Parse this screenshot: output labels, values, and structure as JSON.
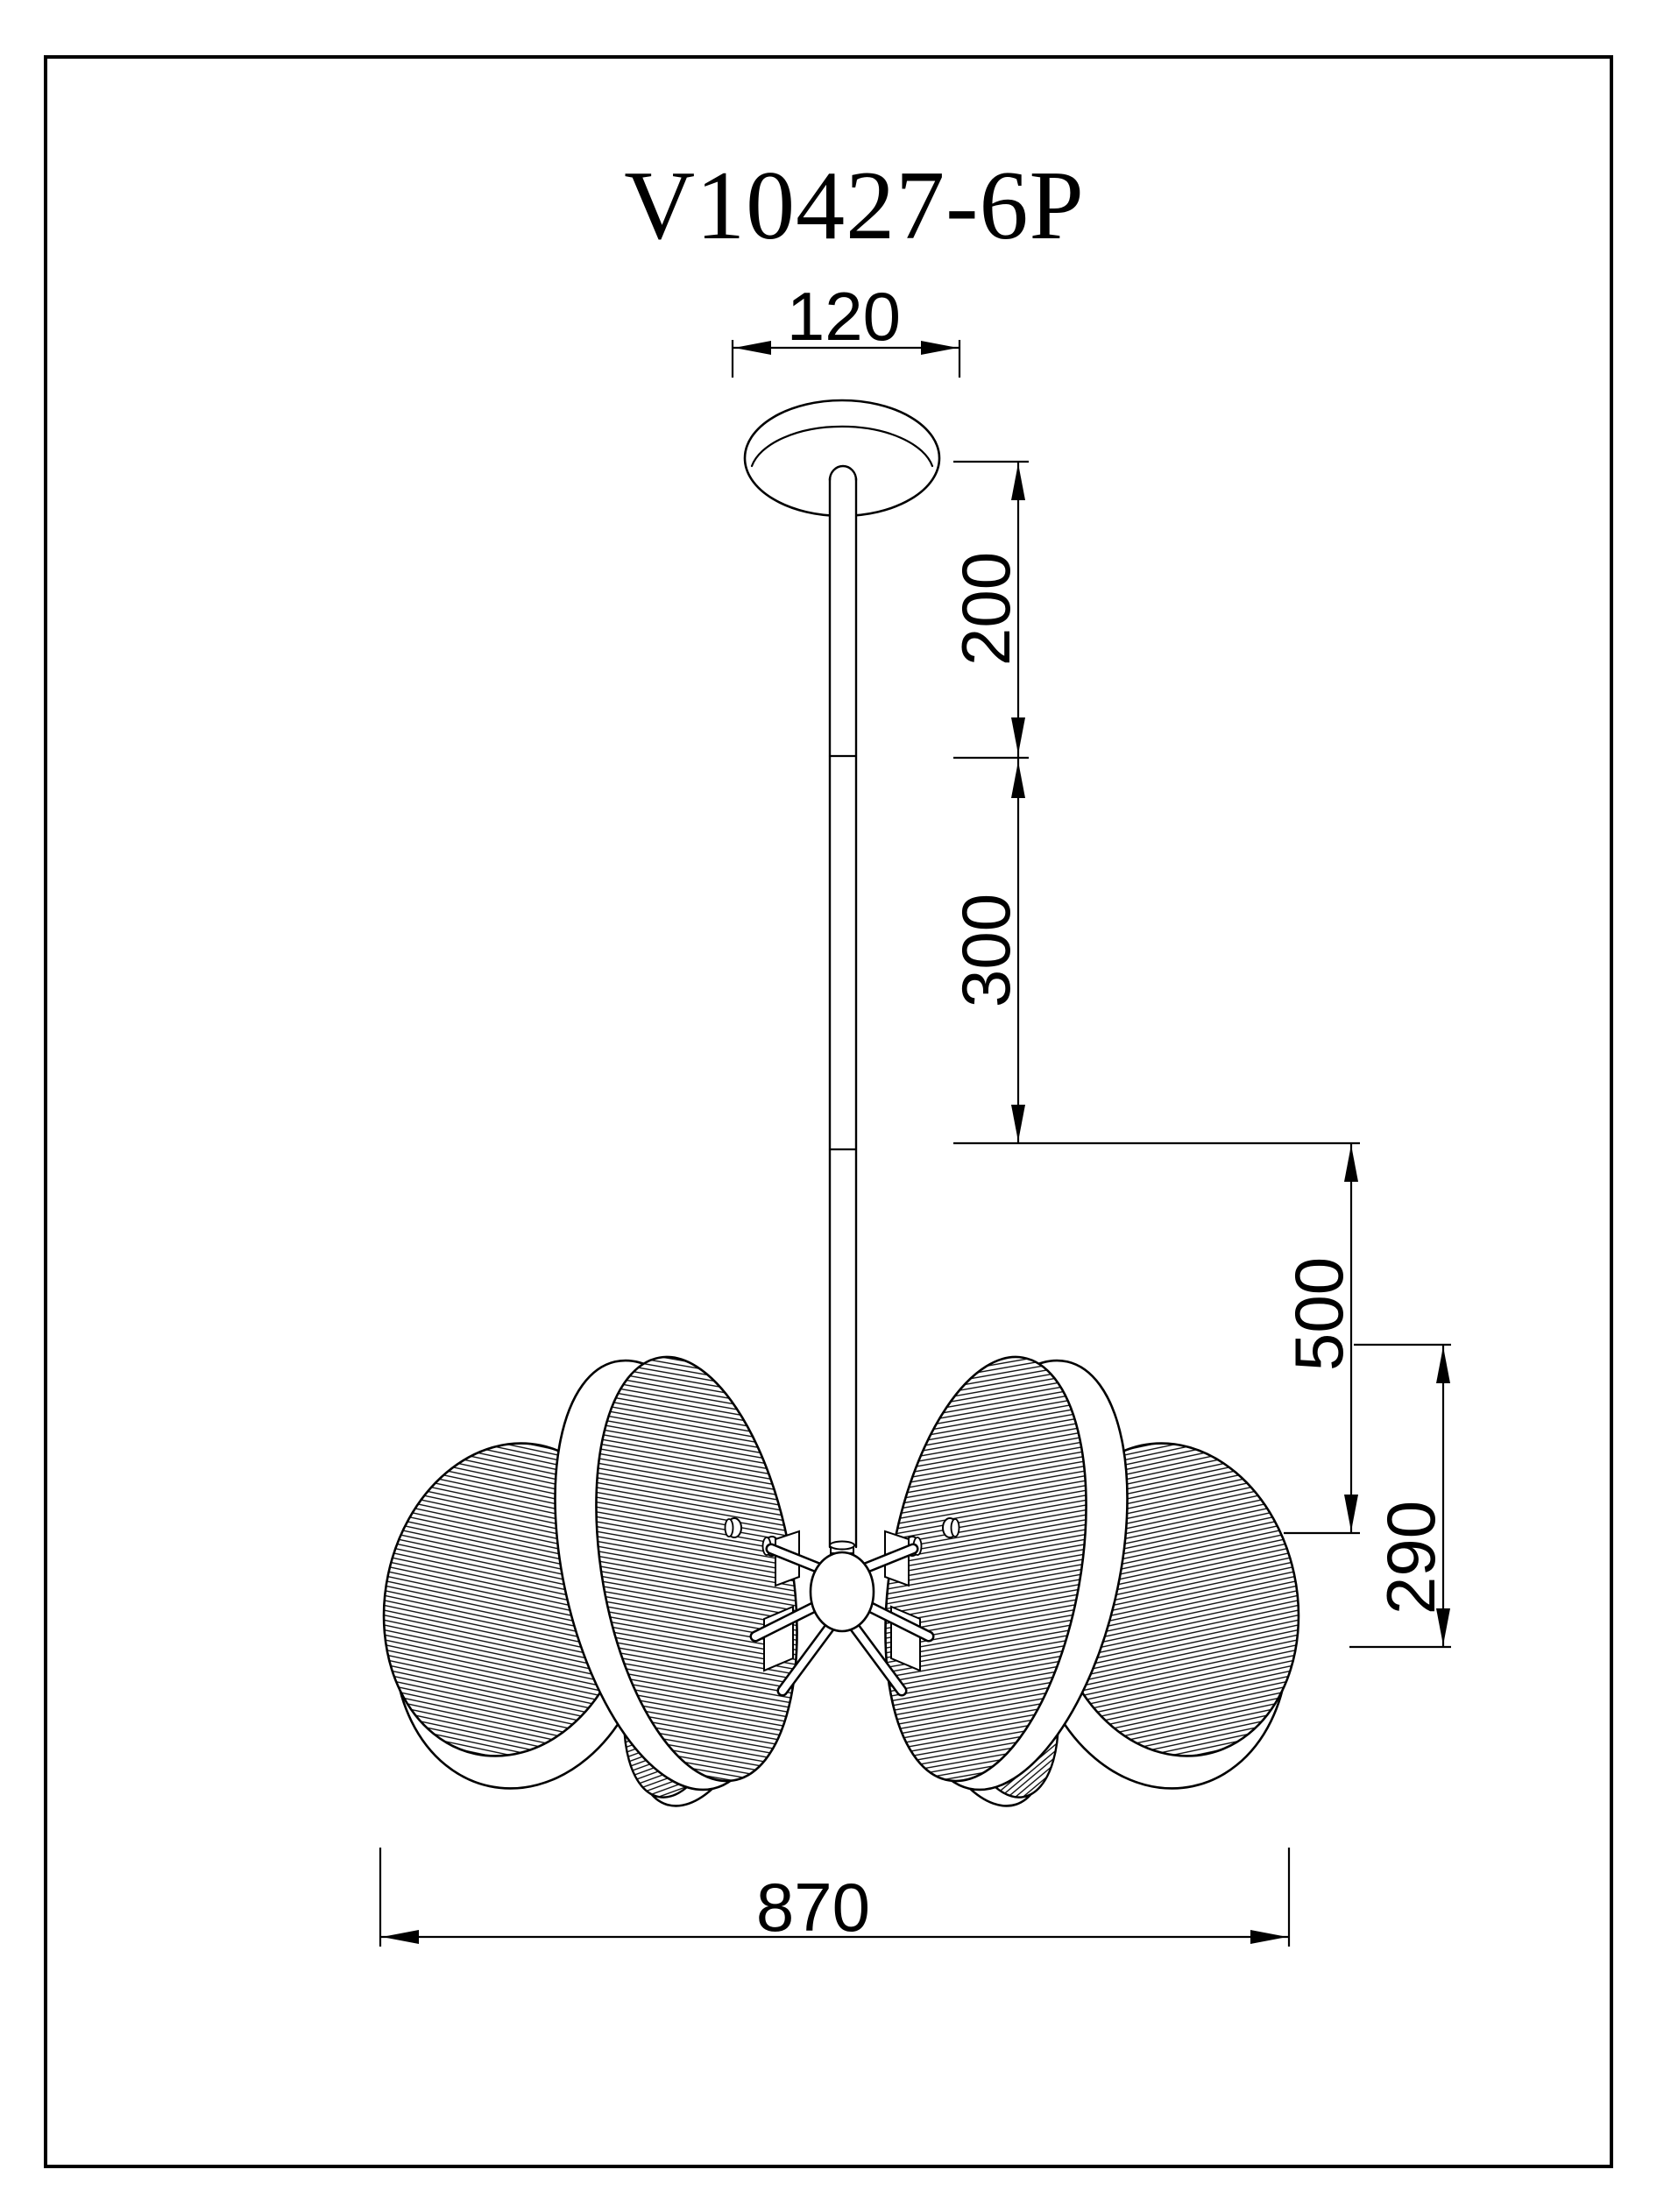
{
  "drawing": {
    "title": "V10427-6P",
    "line_color": "#000000",
    "background_color": "#ffffff",
    "dimensions": {
      "canopy_width": "120",
      "upper_rod_length": "200",
      "lower_rod_length": "300",
      "hub_drop": "500",
      "shade_height": "290",
      "total_width": "870"
    }
  }
}
